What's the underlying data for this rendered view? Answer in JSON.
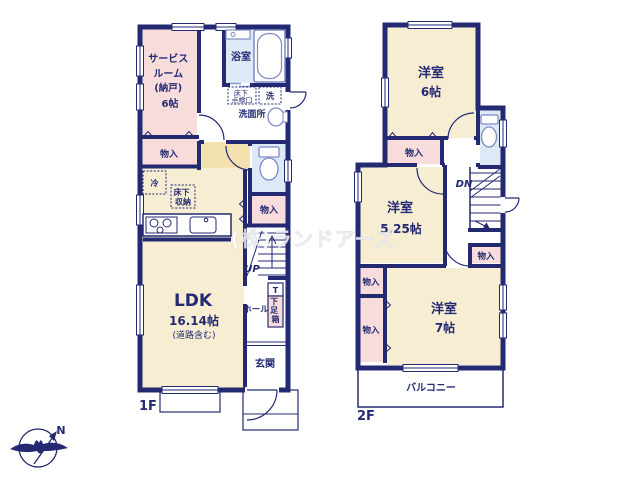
{
  "colors": {
    "wall_navy": "#232a72",
    "room_pink": "#f8dcdc",
    "room_cream": "#f7edd3",
    "corridor_tan": "#f4e1b0",
    "wet_area_blue": "#dde9f6",
    "fixture_outline": "#7f8bc4"
  },
  "watermark": {
    "text": "(株)ランドアーズ"
  },
  "compass": {
    "north": "N"
  },
  "floor1": {
    "label": "1F",
    "service_room": {
      "lines": [
        "サービス",
        "ルーム",
        "(納戸)",
        "6帖"
      ]
    },
    "bathroom": {
      "name": "浴室"
    },
    "washroom": {
      "name": "洗面所"
    },
    "washer": {
      "name": "洗"
    },
    "inspection_hatch": {
      "lines": [
        "床下",
        "点検口"
      ]
    },
    "storage_nw": {
      "name": "物入"
    },
    "storage_e": {
      "name": "物入"
    },
    "refrigerator": {
      "name": "冷"
    },
    "underfloor_storage": {
      "lines": [
        "床下",
        "収納"
      ]
    },
    "stairs": {
      "label": "UP"
    },
    "ldk": {
      "name": "LDK",
      "size": "16.14帖",
      "note": "(道路含む)"
    },
    "hall": {
      "name": "ホール"
    },
    "shoe_box": {
      "tag": "T",
      "chars": [
        "下",
        "足",
        "箱"
      ]
    },
    "entrance": {
      "name": "玄関"
    }
  },
  "floor2": {
    "label": "2F",
    "bedroom_6": {
      "name": "洋室",
      "size": "6帖"
    },
    "storage_n": {
      "name": "物入"
    },
    "bedroom_525": {
      "name": "洋室",
      "size": "5.25帖"
    },
    "stairs": {
      "label": "DN"
    },
    "storage_e": {
      "name": "物入"
    },
    "storage_w_upper": {
      "name": "物入"
    },
    "storage_w_lower": {
      "name": "物入"
    },
    "bedroom_7": {
      "name": "洋室",
      "size": "7帖"
    },
    "balcony": {
      "name": "バルコニー"
    }
  }
}
